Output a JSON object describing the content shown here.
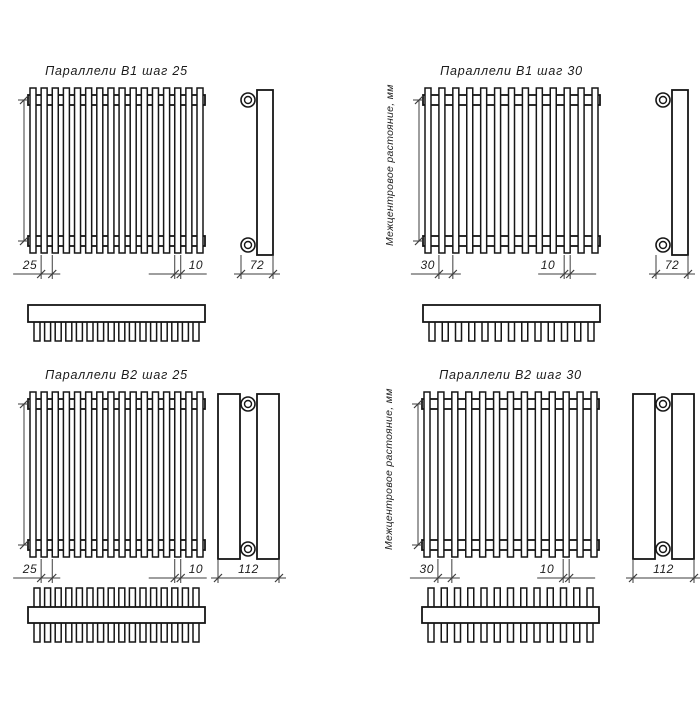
{
  "drawing": {
    "background": "#ffffff",
    "line_color": "#161616",
    "thin_line_color": "#3d3d3d",
    "units_note": "мм",
    "panels": [
      {
        "title": "Параллели В1 шаг 25",
        "axis_label": "Межцентровое растояние, мм",
        "variant": "B1",
        "tube_count": 16,
        "dims": {
          "step": "25",
          "tube_width": "10",
          "depth": "72"
        }
      },
      {
        "title": "Параллели В1 шаг 30",
        "axis_label": "Межцентровое растояние, мм",
        "variant": "B1",
        "tube_count": 13,
        "dims": {
          "step": "30",
          "tube_width": "10",
          "depth": "72"
        }
      },
      {
        "title": "Параллели В2 шаг 25",
        "axis_label": "Межцентровое растояние, мм",
        "variant": "B2",
        "tube_count": 16,
        "dims": {
          "step": "25",
          "tube_width": "10",
          "depth": "112"
        }
      },
      {
        "title": "Параллели В2 шаг 30",
        "axis_label": "Межцентровое растояние, мм",
        "variant": "B2",
        "tube_count": 13,
        "dims": {
          "step": "30",
          "tube_width": "10",
          "depth": "112"
        }
      }
    ]
  }
}
